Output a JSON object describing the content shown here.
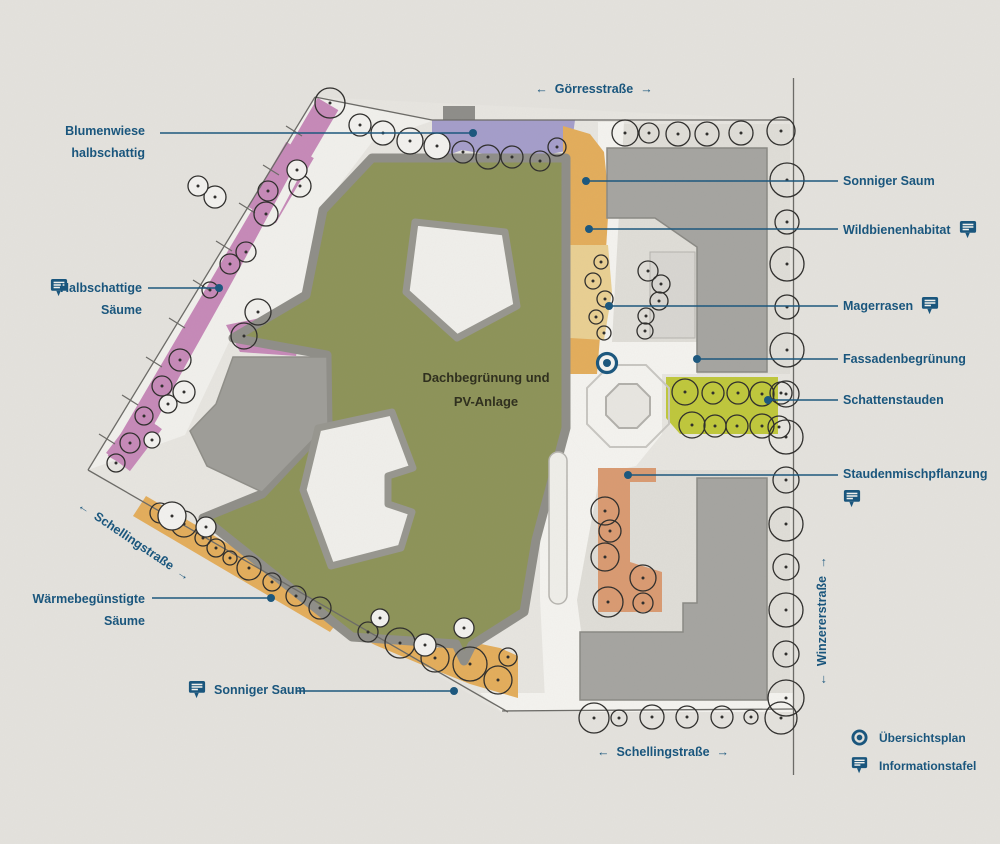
{
  "streets": {
    "goerres": {
      "arrow_left": "←",
      "label": "Görresstraße",
      "arrow_right": "→"
    },
    "schelling_diagonal": {
      "arrow_left": "←",
      "label": "Schellingstraße",
      "arrow_right": "→"
    },
    "schelling_bottom": {
      "arrow_left": "←",
      "label": "Schellingstraße",
      "arrow_right": "→"
    },
    "winzerer": {
      "arrow_left": "←",
      "label": "Winzererstraße",
      "arrow_right": "→"
    }
  },
  "annotations": {
    "blumenwiese": {
      "line1": "Blumenwiese",
      "line2": "halbschattig"
    },
    "halbschattige_saeume": {
      "line1": "Halbschattige",
      "line2": "Säume"
    },
    "waermebeguenstigte_saeume": {
      "line1": "Wärmebegünstigte",
      "line2": "Säume"
    },
    "sonniger_saum_unten": {
      "label": "Sonniger Saum"
    },
    "sonniger_saum_oben": {
      "label": "Sonniger Saum"
    },
    "wildbienenhabitat": {
      "label": "Wildbienenhabitat"
    },
    "magerrasen": {
      "label": "Magerrasen"
    },
    "fassadenbegruenung": {
      "label": "Fassadenbegrünung"
    },
    "schattenstauden": {
      "label": "Schattenstauden"
    },
    "staudenmischpflanzung": {
      "label": "Staudenmischpflanzung"
    },
    "dachbegruenung": {
      "line1": "Dachbegrünung und",
      "line2": "PV-Anlage"
    }
  },
  "legend": {
    "uebersichtsplan": "Übersichtsplan",
    "informationstafel": "Informationstafel"
  },
  "colors": {
    "label_blue": "#1a567d",
    "roof_green": "#8d9358",
    "meadow_pink": "#c689b8",
    "meadow_purple": "#a49dca",
    "saum_orange": "#e3ad5b",
    "stauden_lime": "#bfc73b",
    "stauden_salmon": "#d99a71"
  }
}
